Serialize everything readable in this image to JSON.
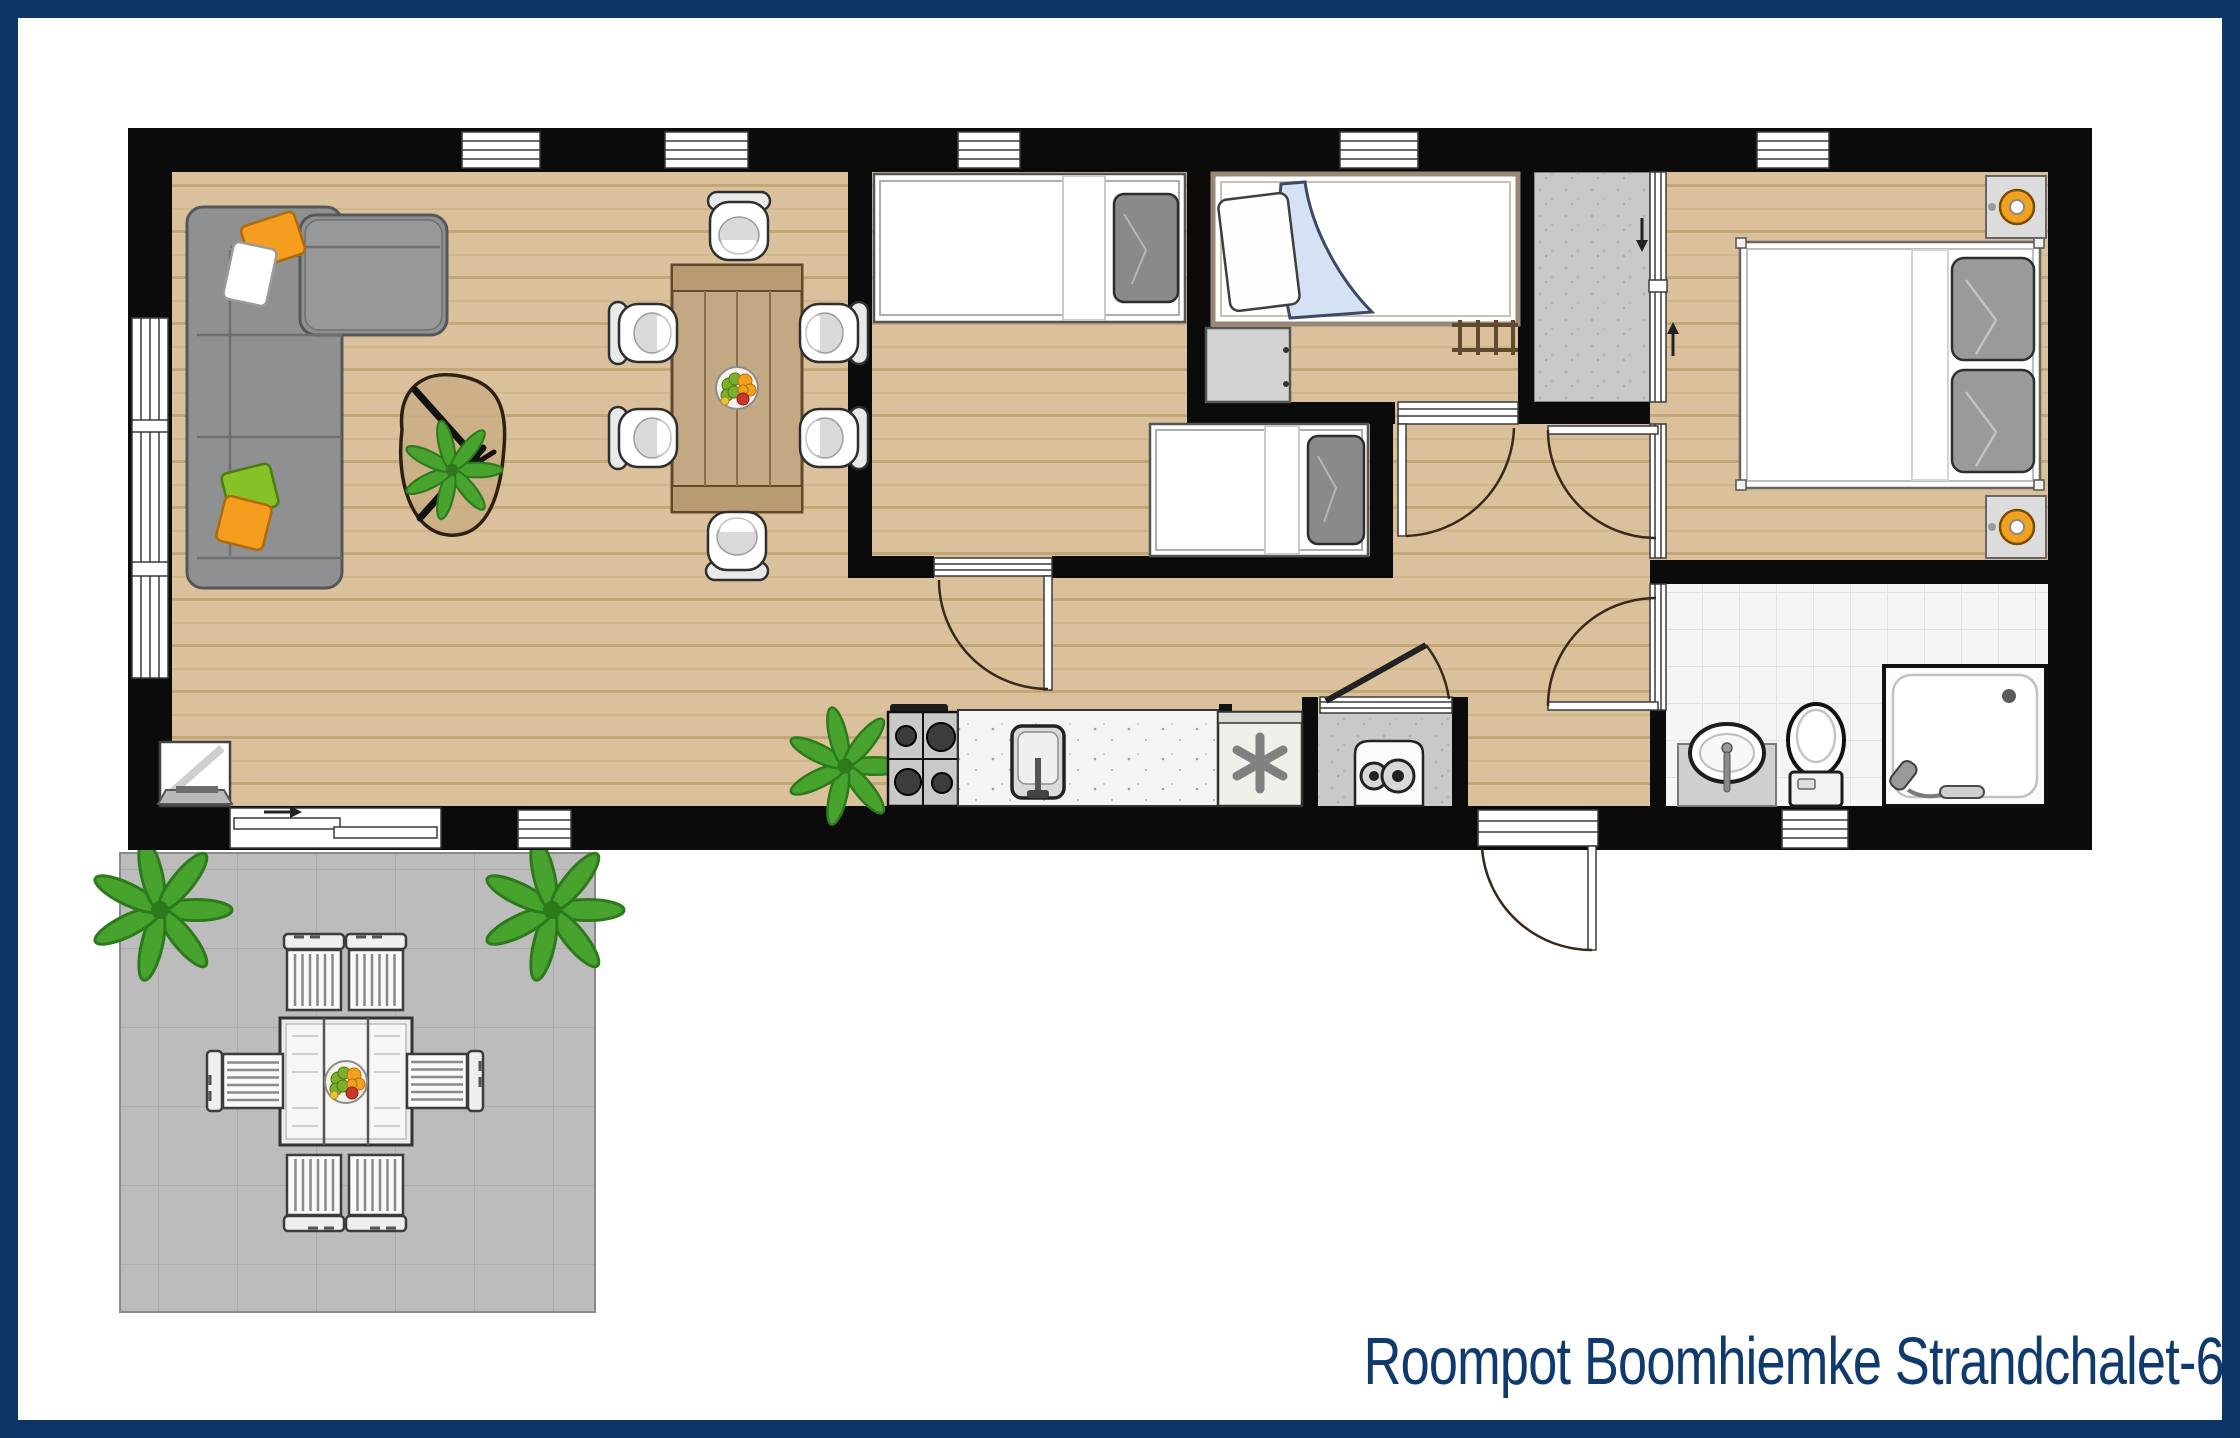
{
  "title": "Roompot Boomhiemke Strandchalet-6",
  "colors": {
    "frame_navy": "#0d3666",
    "title_navy": "#103a6e",
    "wall_black": "#0b0b0b",
    "floor_wood": "#dac19b",
    "bathroom_tile": "#f5f5f4",
    "terrace_gray": "#bcbcbc",
    "closet_gray": "#c9c9c9",
    "sofa_gray": "#8f9092",
    "pillow_orange": "#f59d1e",
    "pillow_white": "#ffffff",
    "pillow_green": "#86c226",
    "blanket_blue": "#d4e2f4",
    "bed_linen_white": "#ffffff",
    "bed2_frame_tan": "#9a8775",
    "lamp_orange": "#f0a11f",
    "plant_green": "#48a32e",
    "outdoor_furniture_gray": "#ececec"
  },
  "rooms": [
    "living-room",
    "dining-area",
    "kitchen",
    "bedroom-two-single-beds",
    "bedroom-single-bed",
    "wardrobe-closet",
    "hallway",
    "master-bedroom",
    "bathroom",
    "terrace"
  ],
  "furniture": [
    "corner-sofa",
    "coffee-table",
    "tv",
    "dining-table",
    "dining-chairs",
    "gas-hob",
    "kitchen-sink",
    "freezer",
    "boiler",
    "single-bed",
    "bunk-ladder",
    "dresser",
    "double-bed",
    "nightstand-lamps",
    "washbasin",
    "toilet",
    "shower",
    "outdoor-table",
    "outdoor-chairs",
    "potted-plants"
  ]
}
